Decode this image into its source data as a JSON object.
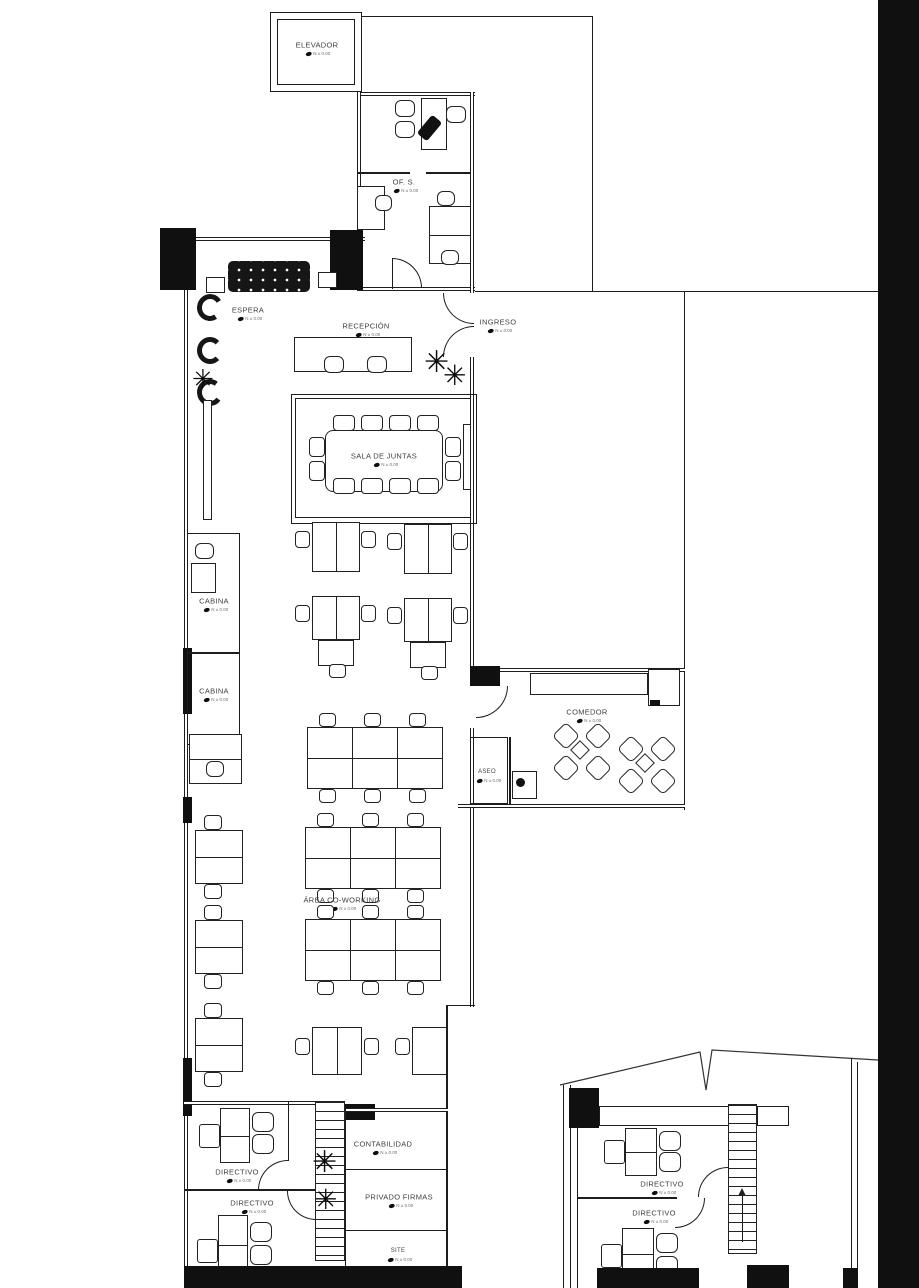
{
  "drawing": {
    "kind": "office floor plan",
    "language": "es"
  },
  "colors": {
    "background": "#ffffff",
    "line": "#1d1d1d",
    "label_text": "#3f3f3f",
    "solid_fill": "#101010"
  },
  "rooms": {
    "elevador": {
      "label": "ELEVADOR",
      "level": "N ± 0.00"
    },
    "of_s": {
      "label": "OF. S.",
      "level": "N ± 0.00"
    },
    "espera": {
      "label": "ESPERA",
      "level": "N ± 0.00"
    },
    "recepcion": {
      "label": "RECEPCIÓN",
      "level": "N ± 0.00"
    },
    "ingreso": {
      "label": "INGRESO",
      "level": "N ± 0.00"
    },
    "sala_de_juntas": {
      "label": "SALA DE JUNTAS",
      "level": "N ± 0.00"
    },
    "cabina_1": {
      "label": "CABINA",
      "level": "N ± 0.00"
    },
    "cabina_2": {
      "label": "CABINA",
      "level": "N ± 0.00"
    },
    "comedor": {
      "label": "COMEDOR",
      "level": "N ± 0.00"
    },
    "aseo": {
      "label": "ASEO",
      "level": "N ± 0.00"
    },
    "area_coworking": {
      "label": "ÁREA CO-WORKING",
      "level": "N ± 0.00"
    },
    "directivo_1": {
      "label": "DIRECTIVO",
      "level": "N ± 0.00"
    },
    "directivo_2": {
      "label": "DIRECTIVO",
      "level": "N ± 0.00"
    },
    "contabilidad": {
      "label": "CONTABILIDAD",
      "level": "N ± 0.00"
    },
    "privado_firmas": {
      "label": "PRIVADO FIRMAS",
      "level": "N ± 0.00"
    },
    "site": {
      "label": "SITE",
      "level": "N ± 0.00"
    },
    "detail_directivo_1": {
      "label": "DIRECTIVO",
      "level": "N ± 0.00"
    },
    "detail_directivo_2": {
      "label": "DIRECTIVO",
      "level": "N ± 0.00"
    }
  },
  "icons": {
    "plant": "✳"
  }
}
